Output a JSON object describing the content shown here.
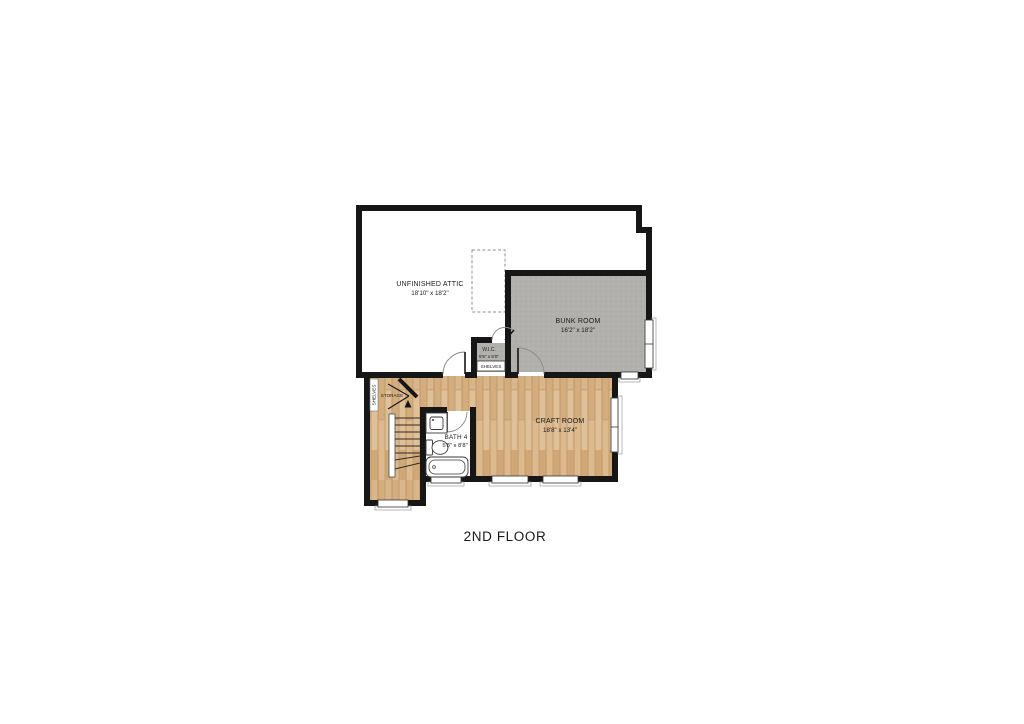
{
  "title": "2ND FLOOR",
  "rooms": {
    "attic": {
      "name": "UNFINISHED ATTIC",
      "dims": "18'10\" x 18'2\""
    },
    "bunk_room": {
      "name": "BUNK ROOM",
      "dims": "16'2\" x 18'2\""
    },
    "craft_room": {
      "name": "CRAFT ROOM",
      "dims": "18'8\" x 13'4\""
    },
    "bath_4": {
      "name": "BATH 4",
      "dims": "5'8\" x 8'8\""
    },
    "wic": {
      "name": "W.I.C.",
      "dims": "5'5\" x 5'0\""
    }
  },
  "annotations": {
    "wic_shelves": "SHELVES",
    "storage": "STORAGE",
    "storage_shelves": "SHELVES"
  },
  "colors": {
    "wall": "#161616",
    "carpet": "#b2b0ad",
    "wood": "#d8b68a",
    "attic_floor": "#ffffff",
    "background": "#ffffff",
    "text": "#1a1a1a"
  }
}
